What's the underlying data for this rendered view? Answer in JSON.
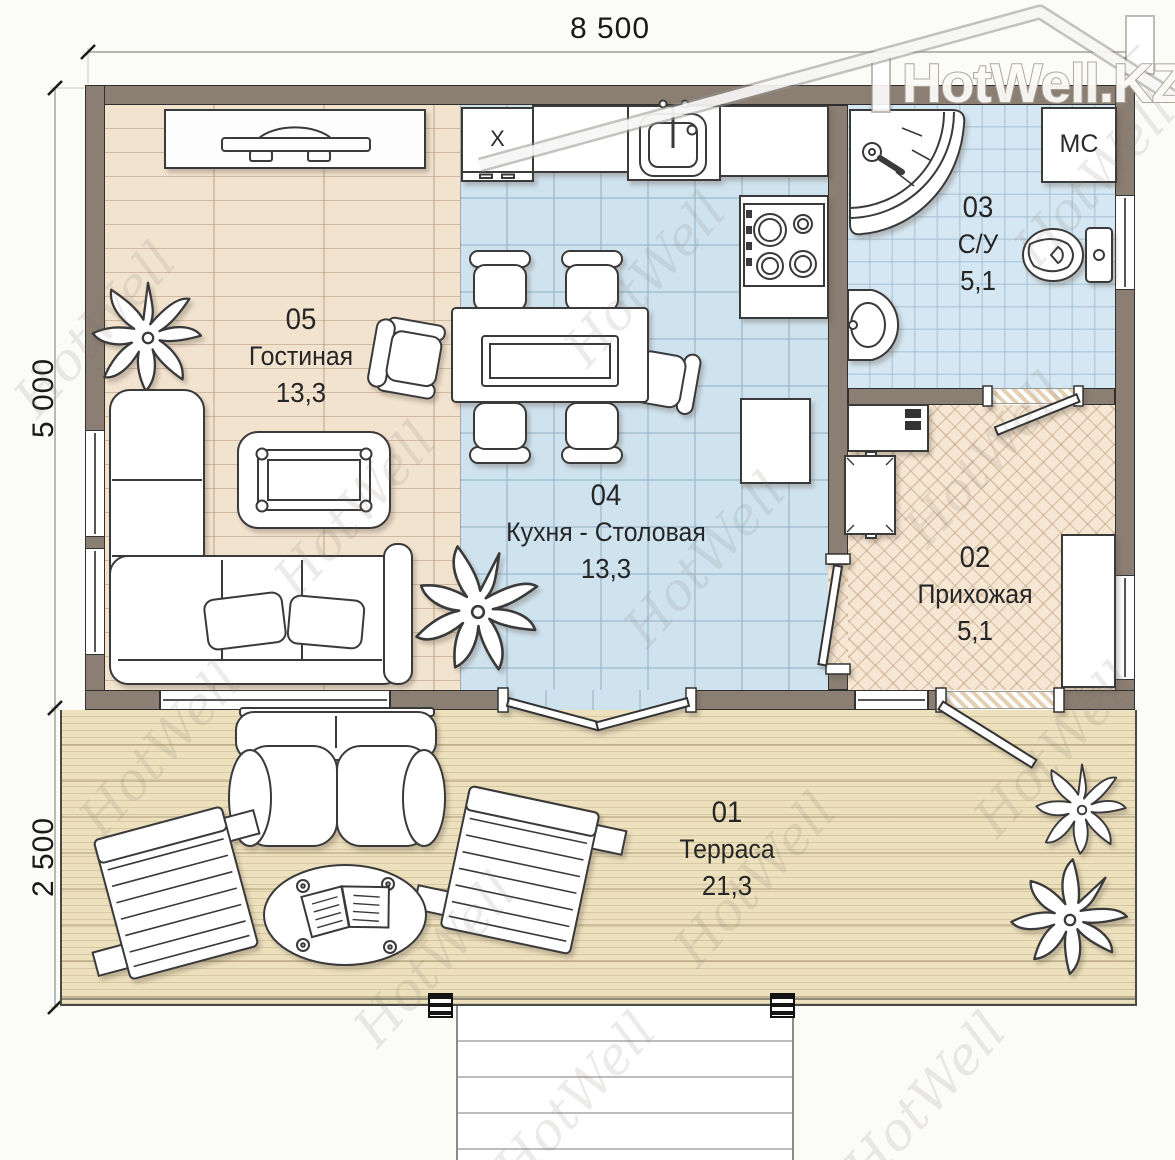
{
  "logo": {
    "text": "HotWell.KZ"
  },
  "watermark": {
    "text": "HotWell"
  },
  "dimensions": {
    "width_top": "8 500",
    "height_main": "5 000",
    "height_terrace": "2 500"
  },
  "rooms": {
    "terrace": {
      "number": "01",
      "name": "Терраса",
      "area": "21,3"
    },
    "hallway": {
      "number": "02",
      "name": "Прихожая",
      "area": "5,1"
    },
    "bathroom": {
      "number": "03",
      "name": "С/У",
      "area": "5,1"
    },
    "kitchen": {
      "number": "04",
      "name": "Кухня - Столовая",
      "area": "13,3"
    },
    "living": {
      "number": "05",
      "name": "Гостиная",
      "area": "13,3"
    }
  },
  "labels": {
    "washing_machine": "МС",
    "cabinet_x": "X"
  },
  "palette": {
    "wall": "#8B7E72",
    "tile_blue": "#CFE3EF",
    "wood": "#F2E3CF",
    "herringbone": "#F5E7D3",
    "deck": "#ECE0BD",
    "outline": "#3A3A3A"
  }
}
